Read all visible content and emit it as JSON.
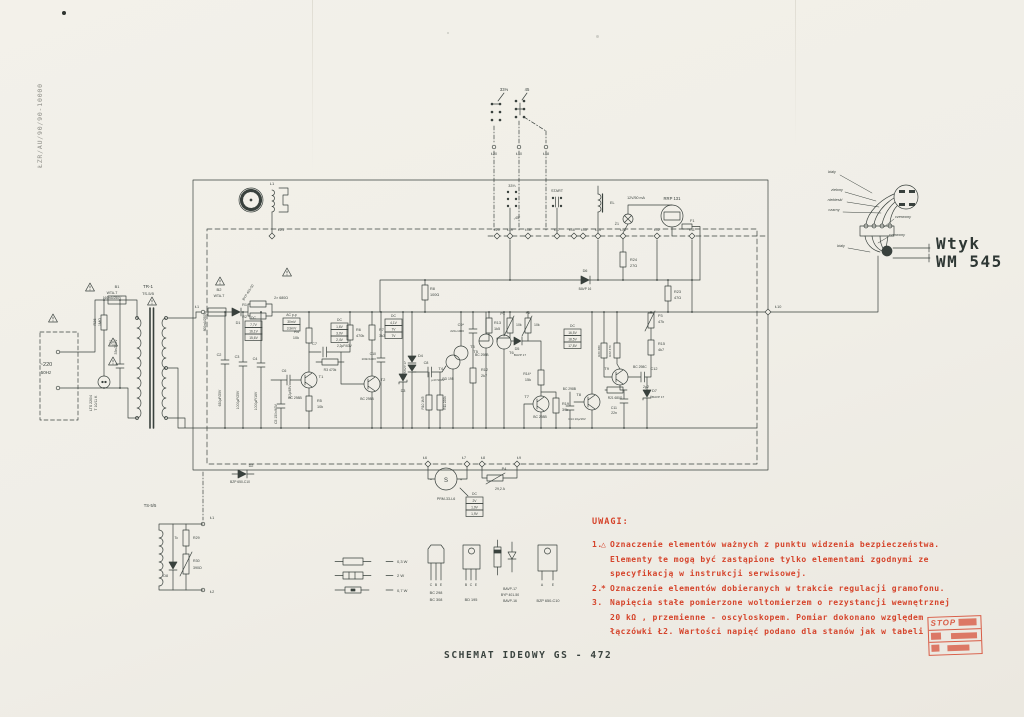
{
  "doc_code": "ŁZR/AU/90/90-10000",
  "title": "SCHEMAT IDEOWY GS - 472",
  "colors": {
    "ink": "#39413d",
    "red": "#d5432a",
    "paper": "#f1efe8"
  },
  "plug": {
    "line1": "Wtyk",
    "line2": "WM 545"
  },
  "stamp": {
    "line1": "STOP"
  },
  "notes": {
    "heading": "UWAGI:",
    "items": [
      {
        "num": "1.",
        "icon": "triangle",
        "lines": [
          "Oznaczenie elementów ważnych z punktu widzenia bezpieczeństwa.",
          "Elementy te mogą być zastąpione tylko elementami zgodnymi ze",
          "specyfikacją w instrukcji serwisowej."
        ]
      },
      {
        "num": "2.",
        "icon": "asterisk",
        "lines": [
          "Oznaczenie elementów dobieranych w trakcie regulacji gramofonu."
        ]
      },
      {
        "num": "3.",
        "icon": "",
        "lines": [
          "Napięcia stałe pomierzone woltomierzem o rezystancji wewnętrznej",
          "20 kΩ , przemienne - oscyloskopem. Pomiar dokonano względem",
          "łączówki Ł2. Wartości napięć podano dla stanów jak w tabeli"
        ]
      }
    ]
  },
  "schematic": {
    "value_boxes": [
      {
        "x": 245,
        "y": 321,
        "header": "DC",
        "rows": [
          "7,7V",
          "16,1V",
          "15,6V"
        ]
      },
      {
        "x": 283,
        "y": 318,
        "header": "AC p-p",
        "rows": [
          "30mV",
          "3,9mV"
        ]
      },
      {
        "x": 331,
        "y": 323,
        "header": "DC",
        "rows": [
          "1,6V",
          "3,0V",
          "2,4V"
        ]
      },
      {
        "x": 385,
        "y": 319,
        "header": "DC",
        "rows": [
          "4,1V",
          "7V",
          "7V"
        ]
      },
      {
        "x": 564,
        "y": 329,
        "header": "DC",
        "rows": [
          "16,5V",
          "18,5V",
          "17,8V"
        ]
      },
      {
        "x": 466,
        "y": 497,
        "header": "DC",
        "rows": [
          "2V",
          "1,9V",
          "1,9V"
        ]
      }
    ],
    "labels": [
      {
        "t": "TR-1",
        "x": 148,
        "y": 288,
        "s": 4.5
      },
      {
        "t": "TS-5/5",
        "x": 148,
        "y": 295,
        "s": 4
      },
      {
        "t": "B1",
        "x": 117,
        "y": 288
      },
      {
        "t": "WTA-T",
        "x": 112,
        "y": 294,
        "s": 3.5
      },
      {
        "t": "160mA/250V",
        "x": 112,
        "y": 299,
        "s": 3.2
      },
      {
        "t": "~220",
        "x": 46,
        "y": 366,
        "s": 5.5
      },
      {
        "t": "50Hz",
        "x": 46,
        "y": 374,
        "s": 4.5
      },
      {
        "t": "R26",
        "x": 96,
        "y": 322,
        "r": -90,
        "s": 3.8
      },
      {
        "t": "1MΩ",
        "x": 101,
        "y": 322,
        "r": -90,
        "s": 3.8
      },
      {
        "t": "LTS 220/4",
        "x": 92,
        "y": 403,
        "r": -90,
        "s": 3.5
      },
      {
        "t": "T 10/11 K",
        "x": 97,
        "y": 403,
        "r": -90,
        "s": 3.5
      },
      {
        "t": "C1",
        "x": 112,
        "y": 342,
        "r": -90,
        "s": 3.8
      },
      {
        "t": "33n/250V",
        "x": 117,
        "y": 347,
        "r": -90,
        "s": 3.5
      },
      {
        "t": "L1",
        "x": 272,
        "y": 185,
        "s": 4
      },
      {
        "t": "Ł21",
        "x": 281,
        "y": 231,
        "s": 3.8
      },
      {
        "t": "Ł1",
        "x": 197,
        "y": 308,
        "s": 3.8
      },
      {
        "t": "B2",
        "x": 219,
        "y": 291,
        "s": 4
      },
      {
        "t": "WTA-T",
        "x": 219,
        "y": 297,
        "s": 3.5
      },
      {
        "t": "800mA/250V",
        "x": 206,
        "y": 322,
        "r": -90,
        "s": 3.2
      },
      {
        "t": "D1",
        "x": 238,
        "y": 324,
        "s": 3.8
      },
      {
        "t": "BYP 401-50",
        "x": 249,
        "y": 293,
        "r": -58,
        "s": 3.4
      },
      {
        "t": "R1",
        "x": 247,
        "y": 306,
        "s": 3.8,
        "a": "end"
      },
      {
        "t": "R2",
        "x": 247,
        "y": 318,
        "s": 3.8,
        "a": "end"
      },
      {
        "t": "2× 680Ω",
        "x": 281,
        "y": 299,
        "s": 3.6
      },
      {
        "t": "C2",
        "x": 219,
        "y": 356,
        "s": 3.8
      },
      {
        "t": "630μF/25V",
        "x": 221,
        "y": 398,
        "r": -90,
        "s": 3.4
      },
      {
        "t": "C3",
        "x": 237,
        "y": 358,
        "s": 3.8
      },
      {
        "t": "1000μF/25V",
        "x": 239,
        "y": 400,
        "r": -90,
        "s": 3.4
      },
      {
        "t": "C4",
        "x": 255,
        "y": 360,
        "s": 3.8
      },
      {
        "t": "1000μF/16V",
        "x": 257,
        "y": 401,
        "r": -90,
        "s": 3.4
      },
      {
        "t": "C5 150n/63V",
        "x": 277,
        "y": 414,
        "r": -90,
        "s": 3.4
      },
      {
        "t": "C6",
        "x": 284,
        "y": 372,
        "s": 3.8
      },
      {
        "t": "2,2μ/63V",
        "x": 291,
        "y": 392,
        "r": -90,
        "s": 3.2
      },
      {
        "t": "R4",
        "x": 299,
        "y": 333,
        "s": 3.8,
        "a": "end"
      },
      {
        "t": "10k",
        "x": 299,
        "y": 339,
        "s": 3.8,
        "a": "end"
      },
      {
        "t": "T1",
        "x": 321,
        "y": 378,
        "s": 4
      },
      {
        "t": "BC 298B",
        "x": 295,
        "y": 399,
        "s": 3.4
      },
      {
        "t": "R5",
        "x": 317,
        "y": 402,
        "s": 3.8,
        "a": "start"
      },
      {
        "t": "10k",
        "x": 317,
        "y": 408,
        "s": 3.8,
        "a": "start"
      },
      {
        "t": "C7",
        "x": 317,
        "y": 345,
        "s": 3.8,
        "a": "end"
      },
      {
        "t": "2,2μF/63V",
        "x": 337,
        "y": 347,
        "s": 3.2,
        "a": "start"
      },
      {
        "t": "R3 470k",
        "x": 330,
        "y": 371,
        "s": 3.4
      },
      {
        "t": "R6",
        "x": 356,
        "y": 331,
        "s": 3.8,
        "a": "start"
      },
      {
        "t": "470k",
        "x": 356,
        "y": 337,
        "s": 3.8,
        "a": "start"
      },
      {
        "t": "R7",
        "x": 379,
        "y": 331,
        "s": 3.8,
        "a": "start"
      },
      {
        "t": "3k3",
        "x": 379,
        "y": 337,
        "s": 3.8,
        "a": "start"
      },
      {
        "t": "T2",
        "x": 383,
        "y": 381,
        "s": 4
      },
      {
        "t": "BC 298B",
        "x": 367,
        "y": 400,
        "s": 3.4
      },
      {
        "t": "R8",
        "x": 430,
        "y": 290,
        "s": 3.8,
        "a": "start"
      },
      {
        "t": "100Ω",
        "x": 430,
        "y": 296,
        "s": 3.8,
        "a": "start"
      },
      {
        "t": "C10",
        "x": 376,
        "y": 355,
        "s": 3.5,
        "a": "end"
      },
      {
        "t": "100n/100V",
        "x": 376,
        "y": 360,
        "s": 3,
        "a": "end"
      },
      {
        "t": "D4",
        "x": 418,
        "y": 357,
        "s": 3.8,
        "a": "start"
      },
      {
        "t": "2×BAVP 17",
        "x": 406,
        "y": 369,
        "r": -90,
        "s": 3.1
      },
      {
        "t": "D3",
        "x": 403,
        "y": 392,
        "s": 3.8
      },
      {
        "t": "C8",
        "x": 426,
        "y": 364,
        "s": 3.8
      },
      {
        "t": "μ47/100V",
        "x": 438,
        "y": 381,
        "s": 3.1
      },
      {
        "t": "R10 1M5",
        "x": 424,
        "y": 403,
        "r": -90,
        "s": 3.2
      },
      {
        "t": "R11 220k",
        "x": 446,
        "y": 403,
        "r": -90,
        "s": 3.2
      },
      {
        "t": "T4",
        "x": 443,
        "y": 370,
        "s": 4,
        "a": "end"
      },
      {
        "t": "BD 195",
        "x": 448,
        "y": 380,
        "s": 3.4
      },
      {
        "t": "T3",
        "x": 470,
        "y": 348,
        "s": 4,
        "a": "start"
      },
      {
        "t": "BC 298B",
        "x": 475,
        "y": 356,
        "s": 3.4,
        "a": "start"
      },
      {
        "t": "R12",
        "x": 481,
        "y": 371,
        "s": 3.8,
        "a": "start"
      },
      {
        "t": "2k7",
        "x": 481,
        "y": 377,
        "s": 3.8,
        "a": "start"
      },
      {
        "t": "C9*",
        "x": 464,
        "y": 326,
        "s": 3.8,
        "a": "end"
      },
      {
        "t": "220÷1000",
        "x": 464,
        "y": 332,
        "s": 3.1,
        "a": "end"
      },
      {
        "t": "R13",
        "x": 494,
        "y": 324,
        "s": 3.8,
        "a": "start"
      },
      {
        "t": "1k5",
        "x": 494,
        "y": 330,
        "s": 3.8,
        "a": "start"
      },
      {
        "t": "P1",
        "x": 505,
        "y": 315,
        "s": 3.8,
        "a": "end"
      },
      {
        "t": "10k",
        "x": 516,
        "y": 326,
        "s": 3.5,
        "a": "start"
      },
      {
        "t": "P2",
        "x": 528,
        "y": 314,
        "s": 3.8
      },
      {
        "t": "10k",
        "x": 534,
        "y": 326,
        "s": 3.5,
        "a": "start"
      },
      {
        "t": "T5",
        "x": 478,
        "y": 353,
        "s": 4,
        "a": "end"
      },
      {
        "t": "T6",
        "x": 509,
        "y": 354,
        "s": 4,
        "a": "start"
      },
      {
        "t": "D5",
        "x": 517,
        "y": 350,
        "s": 3.8
      },
      {
        "t": "BAVP 17",
        "x": 520,
        "y": 356,
        "s": 3.1
      },
      {
        "t": "R14*",
        "x": 531,
        "y": 375,
        "s": 3.5,
        "a": "end"
      },
      {
        "t": "15k",
        "x": 531,
        "y": 381,
        "s": 3.8,
        "a": "end"
      },
      {
        "t": "T7",
        "x": 529,
        "y": 398,
        "s": 4,
        "a": "end"
      },
      {
        "t": "BC 298B",
        "x": 540,
        "y": 418,
        "s": 3.4
      },
      {
        "t": "R19",
        "x": 562,
        "y": 405,
        "s": 3.8,
        "a": "start"
      },
      {
        "t": "39k",
        "x": 562,
        "y": 411,
        "s": 3.8,
        "a": "start"
      },
      {
        "t": "C14 10μ/16V",
        "x": 577,
        "y": 420,
        "s": 3
      },
      {
        "t": "T8",
        "x": 581,
        "y": 396,
        "s": 4,
        "a": "end"
      },
      {
        "t": "BC 298B",
        "x": 576,
        "y": 390,
        "s": 3.3,
        "a": "end"
      },
      {
        "t": "R21 680Ω",
        "x": 615,
        "y": 399,
        "s": 3.2
      },
      {
        "t": "C11",
        "x": 617,
        "y": 409,
        "s": 3.5,
        "a": "end"
      },
      {
        "t": "22n",
        "x": 617,
        "y": 414,
        "s": 3.5,
        "a": "end"
      },
      {
        "t": "D7",
        "x": 652,
        "y": 392,
        "s": 3.8,
        "a": "start"
      },
      {
        "t": "BAVP 17",
        "x": 652,
        "y": 398,
        "s": 3.1,
        "a": "start"
      },
      {
        "t": "C12",
        "x": 654,
        "y": 370,
        "s": 3.8
      },
      {
        "t": "2μ2",
        "x": 646,
        "y": 388,
        "s": 3.5
      },
      {
        "t": "R15",
        "x": 658,
        "y": 345,
        "s": 3.8,
        "a": "start"
      },
      {
        "t": "4k7",
        "x": 658,
        "y": 351,
        "s": 3.8,
        "a": "start"
      },
      {
        "t": "P3",
        "x": 658,
        "y": 317,
        "s": 3.8,
        "a": "start"
      },
      {
        "t": "47k",
        "x": 658,
        "y": 323,
        "s": 3.8,
        "a": "start"
      },
      {
        "t": "R23",
        "x": 674,
        "y": 293,
        "s": 3.8,
        "a": "start"
      },
      {
        "t": "47Ω",
        "x": 674,
        "y": 299,
        "s": 3.8,
        "a": "start"
      },
      {
        "t": "R20 680",
        "x": 600,
        "y": 351,
        "r": -90,
        "s": 3.1
      },
      {
        "t": "R22 470",
        "x": 611,
        "y": 351,
        "r": -90,
        "s": 3.1
      },
      {
        "t": "T9",
        "x": 609,
        "y": 370,
        "s": 4,
        "a": "end"
      },
      {
        "t": "BC 298C",
        "x": 633,
        "y": 368,
        "s": 3.4,
        "a": "start"
      },
      {
        "t": "D6",
        "x": 585,
        "y": 272,
        "s": 3.8
      },
      {
        "t": "BAVP 16",
        "x": 585,
        "y": 290,
        "s": 3.2
      },
      {
        "t": "R24",
        "x": 630,
        "y": 261,
        "s": 3.8,
        "a": "start"
      },
      {
        "t": "27Ω",
        "x": 630,
        "y": 267,
        "s": 3.8,
        "a": "start"
      },
      {
        "t": "Ł10",
        "x": 775,
        "y": 308,
        "s": 3.8,
        "a": "start"
      },
      {
        "t": "33⅓",
        "x": 504,
        "y": 91,
        "s": 4.2
      },
      {
        "t": "45",
        "x": 527,
        "y": 91,
        "s": 4.2
      },
      {
        "t": "Ł20",
        "x": 494,
        "y": 155,
        "s": 3.6
      },
      {
        "t": "Ł10",
        "x": 519,
        "y": 155,
        "s": 3.6
      },
      {
        "t": "Ł18",
        "x": 546,
        "y": 155,
        "s": 3.6
      },
      {
        "t": "33⅓",
        "x": 512,
        "y": 187,
        "s": 3.8
      },
      {
        "t": "„45”",
        "x": 517,
        "y": 219,
        "s": 3.6
      },
      {
        "t": "START",
        "x": 557,
        "y": 192,
        "s": 3.8
      },
      {
        "t": "EL",
        "x": 610,
        "y": 204,
        "s": 3.8,
        "a": "start"
      },
      {
        "t": "Ż1",
        "x": 619,
        "y": 225,
        "s": 3.6,
        "a": "end"
      },
      {
        "t": "12V/50 mA",
        "x": 636,
        "y": 199,
        "s": 3.6
      },
      {
        "t": "RRP 131",
        "x": 672,
        "y": 200,
        "s": 4.2
      },
      {
        "t": "F1",
        "x": 690,
        "y": 222,
        "s": 3.8,
        "a": "start"
      },
      {
        "t": "Ł20",
        "x": 497,
        "y": 231,
        "s": 3.4
      },
      {
        "t": "Ł19",
        "x": 510,
        "y": 231,
        "s": 3.4
      },
      {
        "t": "Ł18",
        "x": 528,
        "y": 231,
        "s": 3.4
      },
      {
        "t": "Ł17",
        "x": 557,
        "y": 231,
        "s": 3.4
      },
      {
        "t": "Ł16",
        "x": 572,
        "y": 231,
        "s": 3.4
      },
      {
        "t": "Ł15",
        "x": 584,
        "y": 231,
        "s": 3.4
      },
      {
        "t": "Ł14",
        "x": 598,
        "y": 231,
        "s": 3.4
      },
      {
        "t": "Ł13",
        "x": 623,
        "y": 231,
        "s": 3.4
      },
      {
        "t": "Ł12",
        "x": 657,
        "y": 231,
        "s": 3.4
      },
      {
        "t": "Ł11",
        "x": 692,
        "y": 231,
        "s": 3.4
      },
      {
        "t": "Ł6",
        "x": 425,
        "y": 459,
        "s": 3.6
      },
      {
        "t": "Ł7",
        "x": 464,
        "y": 459,
        "s": 3.6
      },
      {
        "t": "Ł8",
        "x": 483,
        "y": 459,
        "s": 3.6
      },
      {
        "t": "Ł9",
        "x": 519,
        "y": 459,
        "s": 3.6
      },
      {
        "t": "S",
        "x": 446,
        "y": 482,
        "s": 6
      },
      {
        "t": "−",
        "x": 431,
        "y": 481,
        "s": 4
      },
      {
        "t": "+",
        "x": 461,
        "y": 481,
        "s": 4
      },
      {
        "t": "PRM-33-L6",
        "x": 446,
        "y": 500,
        "s": 3.6
      },
      {
        "t": "P4",
        "x": 504,
        "y": 470,
        "s": 3.8
      },
      {
        "t": "29,2 A",
        "x": 500,
        "y": 490,
        "s": 3.5
      },
      {
        "t": "D2",
        "x": 251,
        "y": 467,
        "s": 3.8
      },
      {
        "t": "BZP 650-C10",
        "x": 240,
        "y": 483,
        "s": 3.3
      },
      {
        "t": "TS-5/5",
        "x": 150,
        "y": 507,
        "s": 4.2
      },
      {
        "t": "Ł1",
        "x": 210,
        "y": 519,
        "s": 3.8,
        "a": "start"
      },
      {
        "t": "Ł2",
        "x": 210,
        "y": 593,
        "s": 3.8,
        "a": "start"
      },
      {
        "t": "Tc",
        "x": 178,
        "y": 539,
        "s": 3.5,
        "a": "end"
      },
      {
        "t": "R29",
        "x": 193,
        "y": 539,
        "s": 3.6,
        "a": "start"
      },
      {
        "t": "R30",
        "x": 193,
        "y": 562,
        "s": 3.6,
        "a": "start"
      },
      {
        "t": "390Ω",
        "x": 193,
        "y": 569,
        "s": 3.6,
        "a": "start"
      },
      {
        "t": "D8",
        "x": 168,
        "y": 577,
        "s": 3.6,
        "a": "end"
      },
      {
        "t": "0,3 W",
        "x": 397,
        "y": 563,
        "s": 4,
        "a": "start"
      },
      {
        "t": "2 W",
        "x": 397,
        "y": 577,
        "s": 4,
        "a": "start"
      },
      {
        "t": "0,7 W",
        "x": 397,
        "y": 592,
        "s": 4,
        "a": "start"
      },
      {
        "t": "C",
        "x": 431,
        "y": 586,
        "s": 3.4
      },
      {
        "t": "B",
        "x": 436,
        "y": 586,
        "s": 3.4
      },
      {
        "t": "E",
        "x": 441,
        "y": 586,
        "s": 3.4
      },
      {
        "t": "BC 298",
        "x": 436,
        "y": 594,
        "s": 3.8
      },
      {
        "t": "BC 308",
        "x": 436,
        "y": 601,
        "s": 3.8
      },
      {
        "t": "B",
        "x": 466,
        "y": 586,
        "s": 3.4
      },
      {
        "t": "C",
        "x": 471,
        "y": 586,
        "s": 3.4
      },
      {
        "t": "E",
        "x": 476,
        "y": 586,
        "s": 3.4
      },
      {
        "t": "BD 195",
        "x": 471,
        "y": 601,
        "s": 3.8
      },
      {
        "t": "BAVP-17",
        "x": 510,
        "y": 590,
        "s": 3.4
      },
      {
        "t": "BYP 401-50",
        "x": 510,
        "y": 596,
        "s": 3.4
      },
      {
        "t": "BAVP-16",
        "x": 510,
        "y": 602,
        "s": 3.4
      },
      {
        "t": "A",
        "x": 542,
        "y": 586,
        "s": 3.4
      },
      {
        "t": "E",
        "x": 553,
        "y": 586,
        "s": 3.4
      },
      {
        "t": "BZP 650-C10",
        "x": 548,
        "y": 602,
        "s": 3.8
      },
      {
        "t": "biały",
        "x": 832,
        "y": 173,
        "i": 1,
        "s": 3.8
      },
      {
        "t": "zielony",
        "x": 837,
        "y": 191,
        "i": 1,
        "s": 3.8
      },
      {
        "t": "niebieski",
        "x": 835,
        "y": 201,
        "i": 1,
        "s": 3.8
      },
      {
        "t": "czarny",
        "x": 834,
        "y": 211,
        "i": 1,
        "s": 3.8
      },
      {
        "t": "czerwony",
        "x": 903,
        "y": 218,
        "i": 1,
        "s": 3.8
      },
      {
        "t": "czerwony",
        "x": 897,
        "y": 236,
        "i": 1,
        "s": 3.8
      },
      {
        "t": "biały",
        "x": 841,
        "y": 247,
        "i": 1,
        "s": 3.8
      }
    ]
  }
}
